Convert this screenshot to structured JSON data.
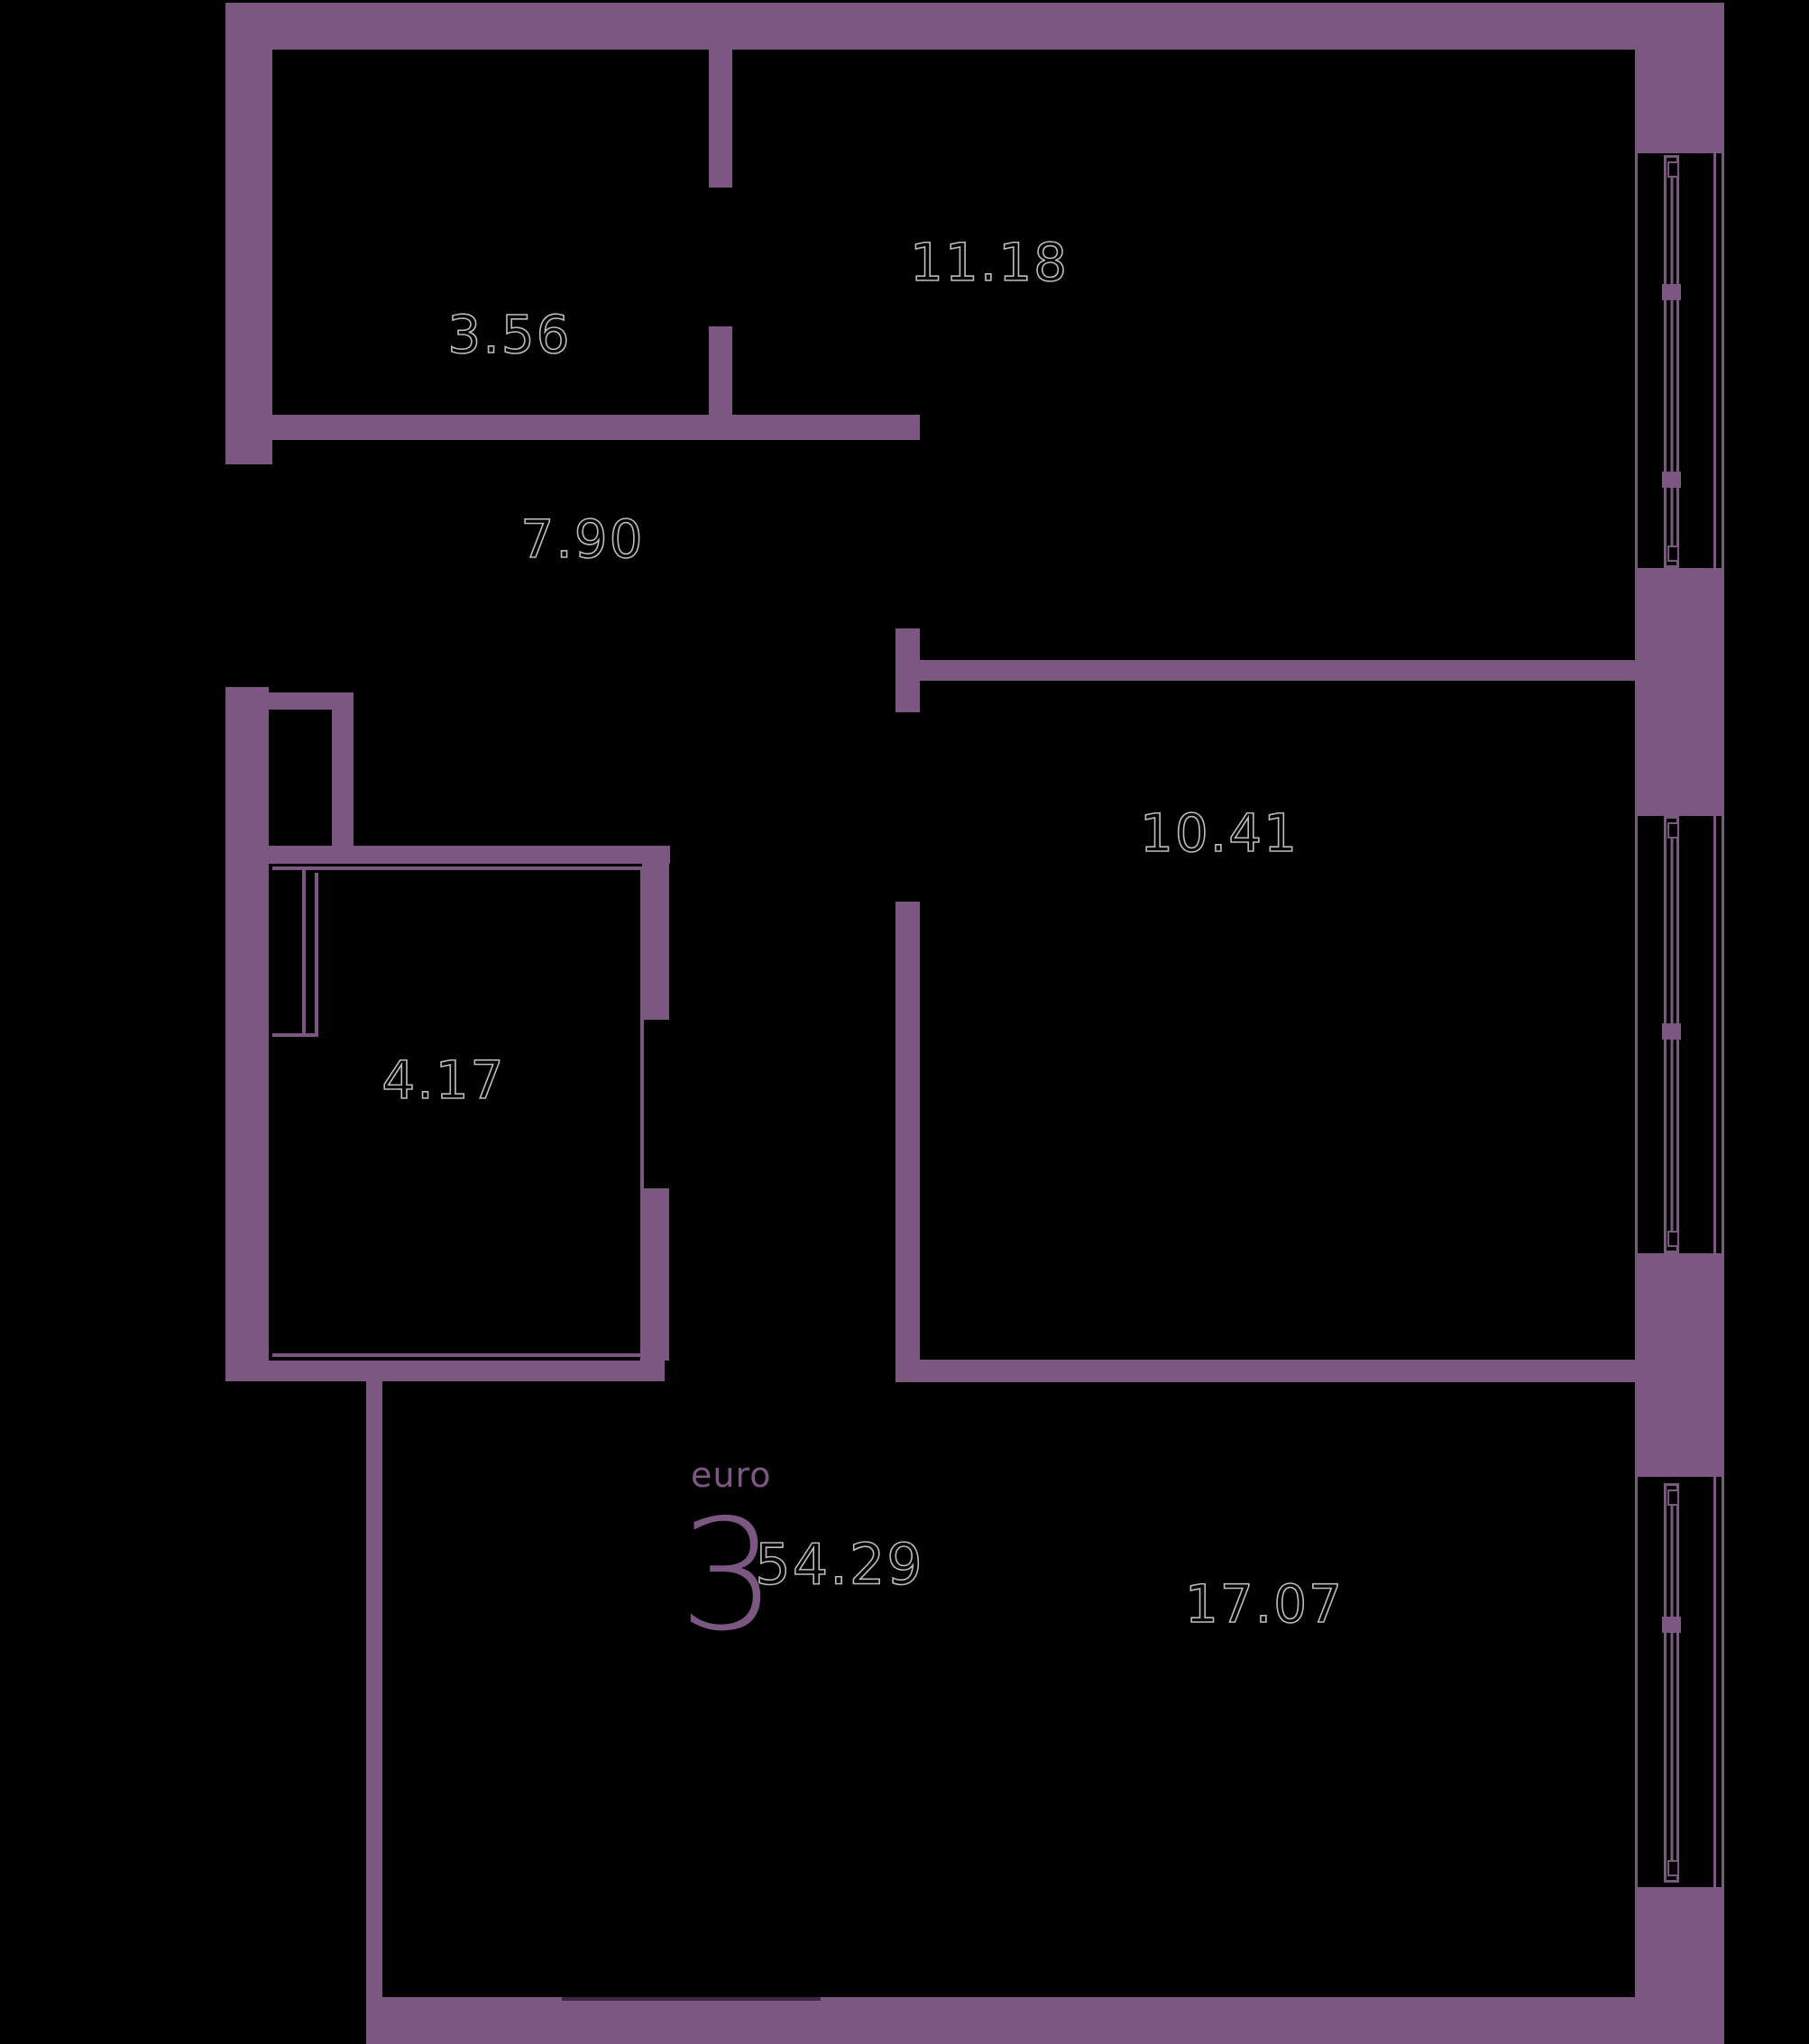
{
  "plan": {
    "unit": {
      "type_label": "euro",
      "rooms_count": "3",
      "total_area": "54.29"
    },
    "room_areas": [
      "3.56",
      "11.18",
      "7.90",
      "10.41",
      "4.17",
      "17.07"
    ],
    "colors": {
      "wall": "#7b5782",
      "background": "#000000",
      "area_label_outline": "#bdbdbd",
      "area_label_fill": "#000000"
    }
  }
}
